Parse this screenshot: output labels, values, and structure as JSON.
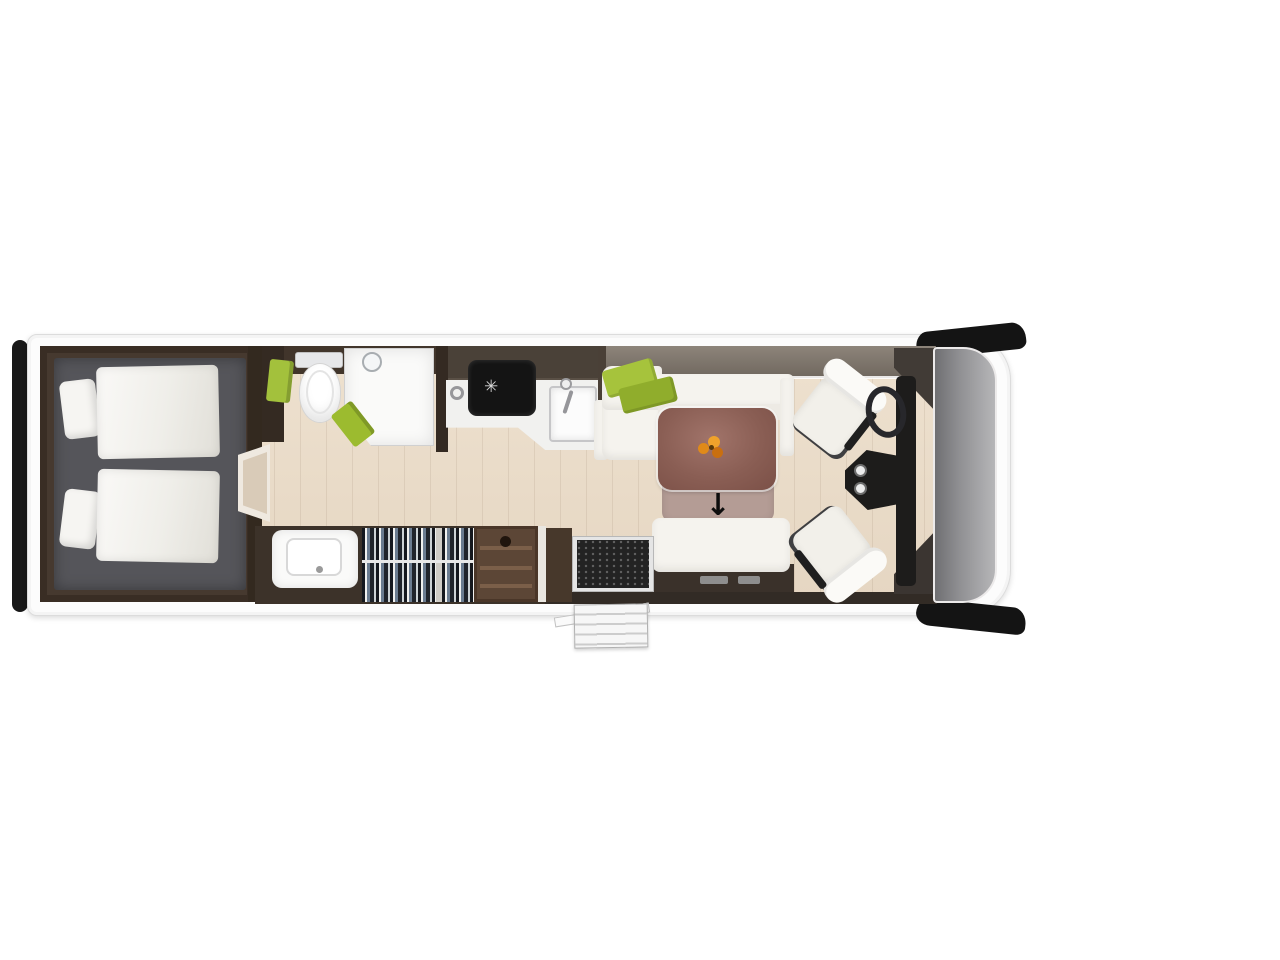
{
  "scene": {
    "type": "motorhome floor plan, top-down render",
    "view": "top",
    "background_color": "#ffffff"
  },
  "palette": {
    "body": "#fcfcfc",
    "floor_wood": "#e9dccb",
    "bedroom_floor": "#56565a",
    "dark_furniture": "#46392f",
    "upholstery": "#f5f3ee",
    "accent_green": "#a3c13c",
    "table_top": "#8a5e54",
    "table_extension": "#b49c95",
    "windshield_glass": "#9a9a9d",
    "trim_black": "#1a1a1a"
  },
  "glyphs": {
    "table_extension_arrow": "↓",
    "hob_burner": "✳"
  },
  "inventory": {
    "rear_bedroom": [
      "twin-bed-upper",
      "twin-bed-lower",
      "pillows",
      "rear-bumper"
    ],
    "washroom": [
      "toilet",
      "corner-shower",
      "green-towels",
      "washbasin"
    ],
    "storage": [
      "wardrobe-hanging-clothes",
      "open-shelf-unit"
    ],
    "kitchen": [
      "hob",
      "sink-with-tap",
      "worktop"
    ],
    "lounge": [
      "l-shaped-sofa",
      "green-cushions",
      "dining-table-with-flowers",
      "pull-out-extension",
      "travel-seat-bench"
    ],
    "cab": [
      "driver-swivel-seat",
      "passenger-swivel-seat",
      "steering-wheel",
      "dashboard-cup-holders",
      "windshield",
      "side-mirror-top",
      "side-mirror-bottom"
    ],
    "entrance": [
      "entry-door-mat",
      "exterior-steps",
      "open-door"
    ]
  }
}
